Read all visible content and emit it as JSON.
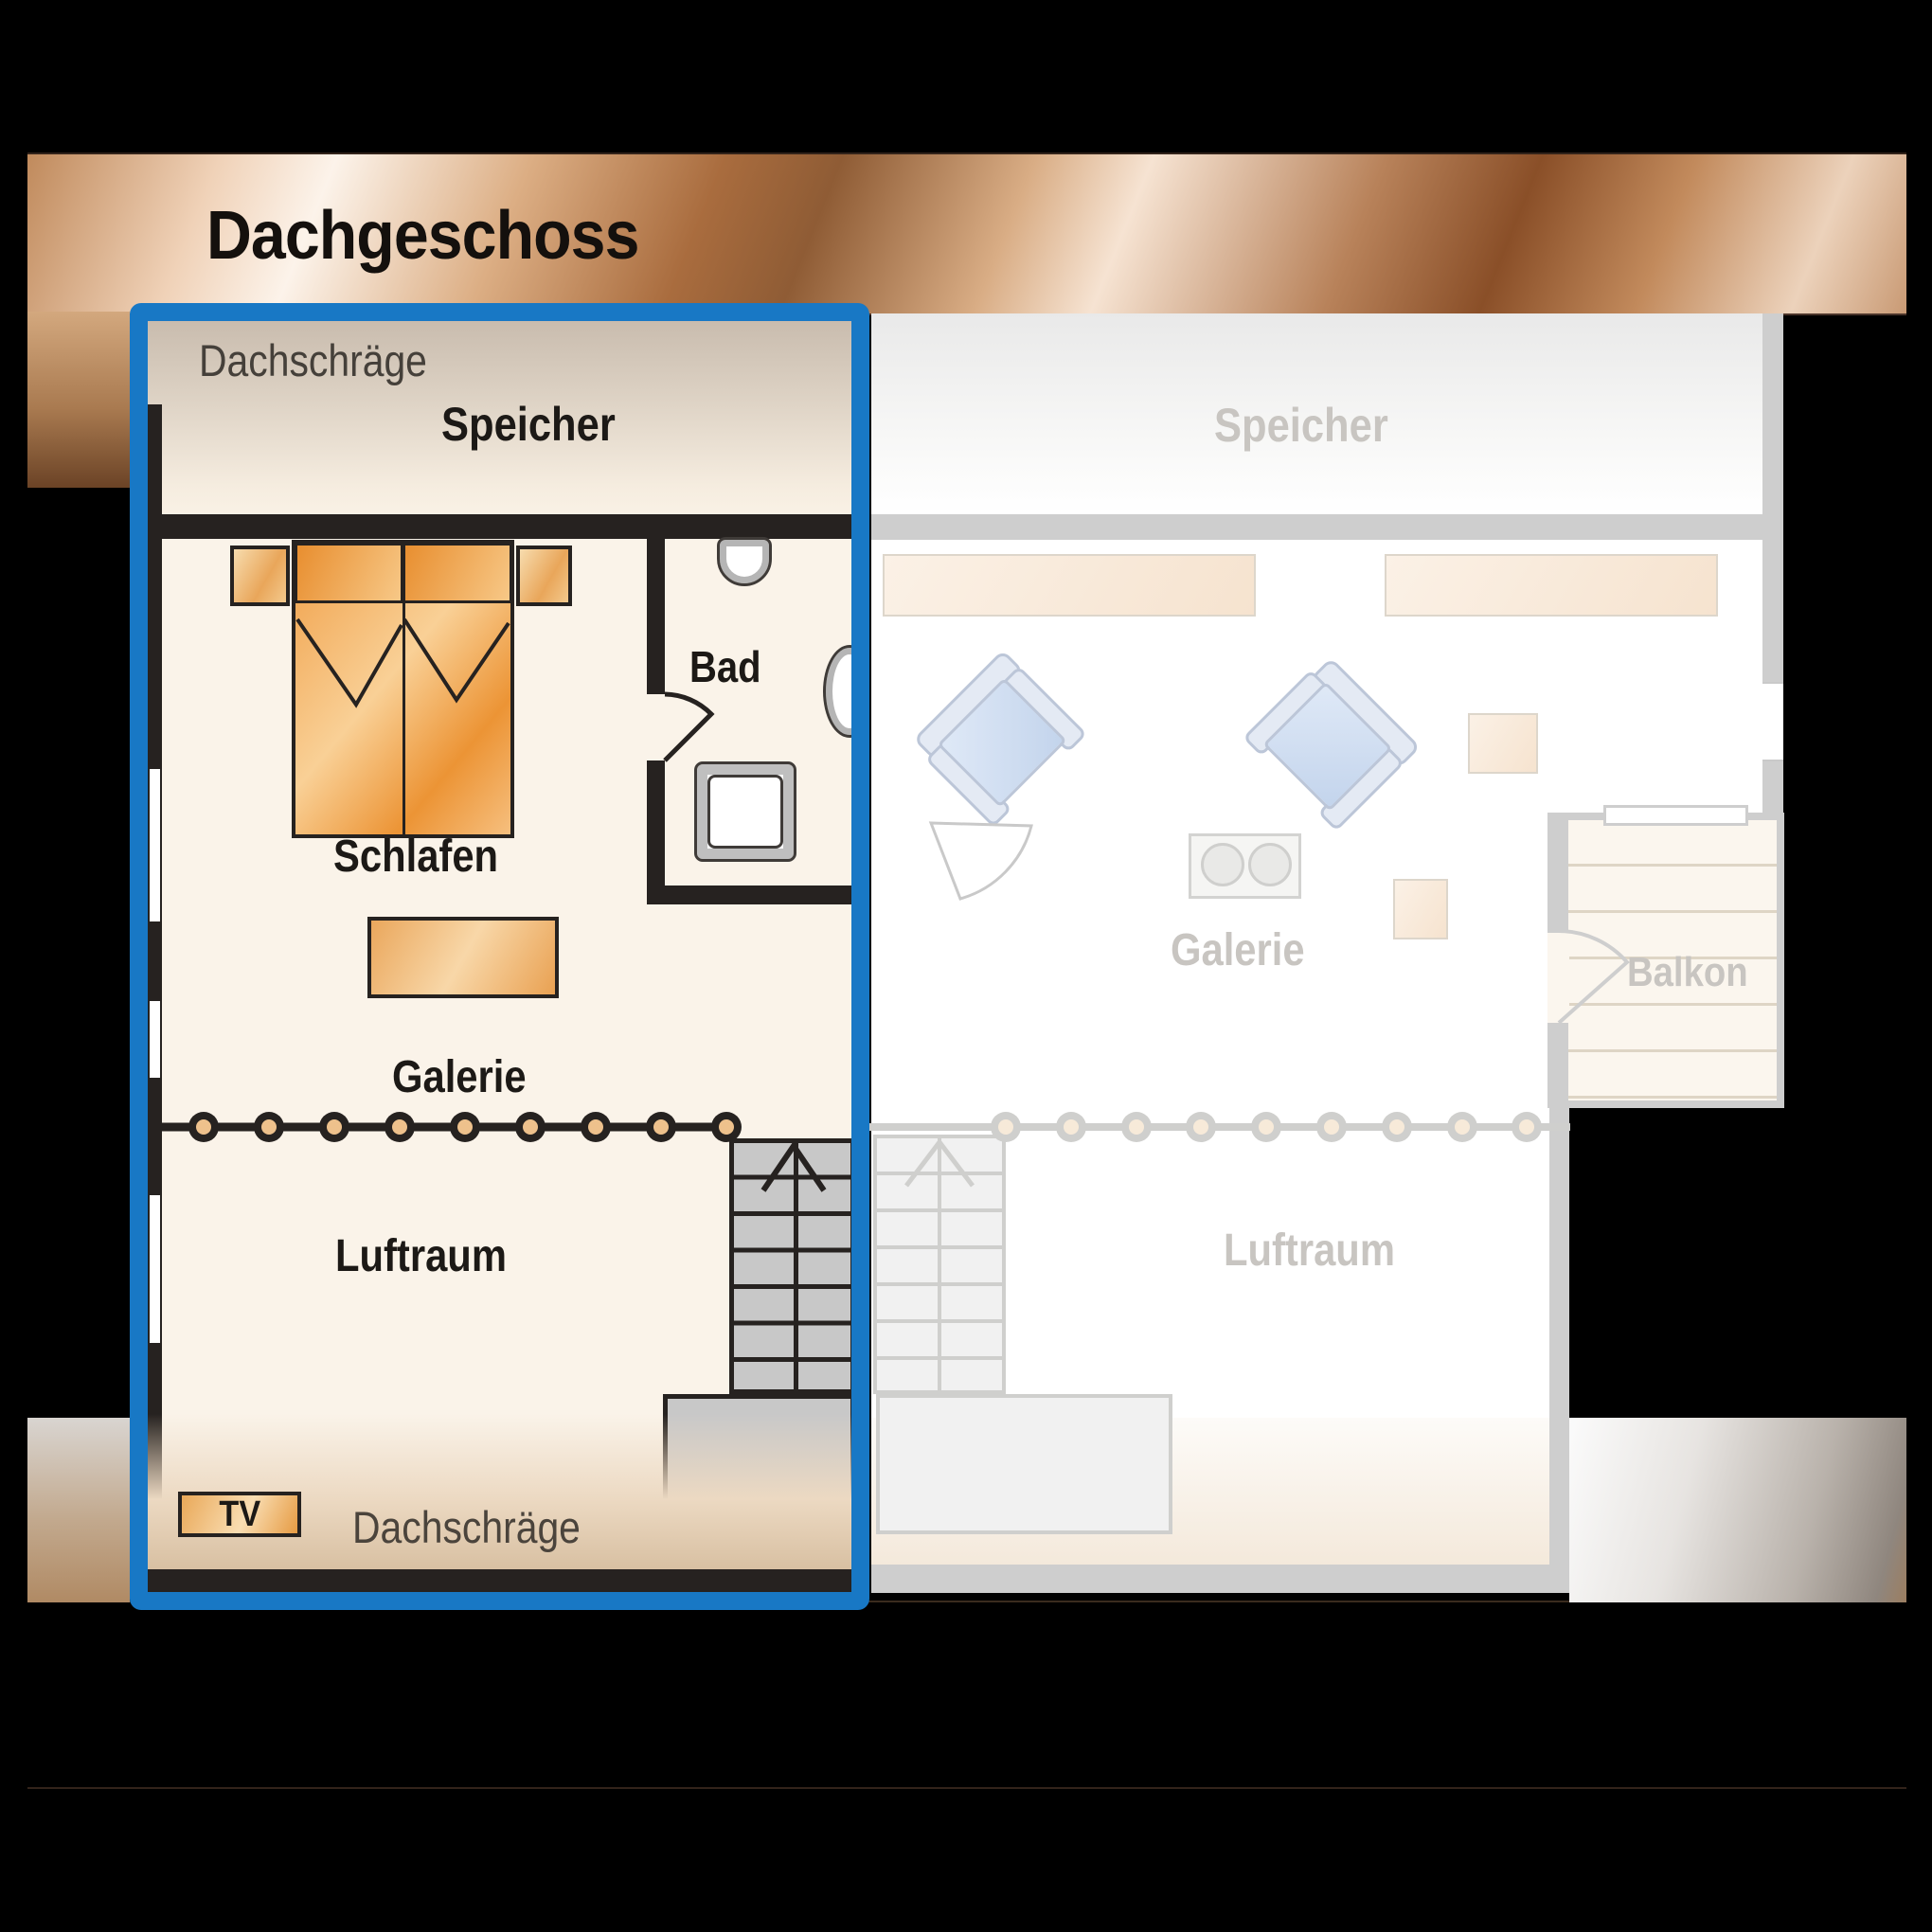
{
  "title": "Dachgeschoss",
  "highlighted_plan": {
    "labels": {
      "roof_slope_top": "Dachschräge",
      "attic": "Speicher",
      "bathroom": "Bad",
      "bedroom": "Schlafen",
      "gallery": "Galerie",
      "air_space": "Luftraum",
      "tv": "TV",
      "roof_slope_bottom": "Dachschräge"
    }
  },
  "faded_plan": {
    "labels": {
      "attic": "Speicher",
      "gallery": "Galerie",
      "balcony": "Balkon",
      "air_space": "Luftraum"
    }
  },
  "colors": {
    "highlight_border": "#1878c5",
    "wall": "#262220",
    "floor": "#faf3e9",
    "copper_band": "#c0763d",
    "furniture_orange": "#ef9a3f",
    "faded_wall": "#cecece",
    "faded_text": "#c8c5c1",
    "railing_post_center": "#eec18c"
  }
}
